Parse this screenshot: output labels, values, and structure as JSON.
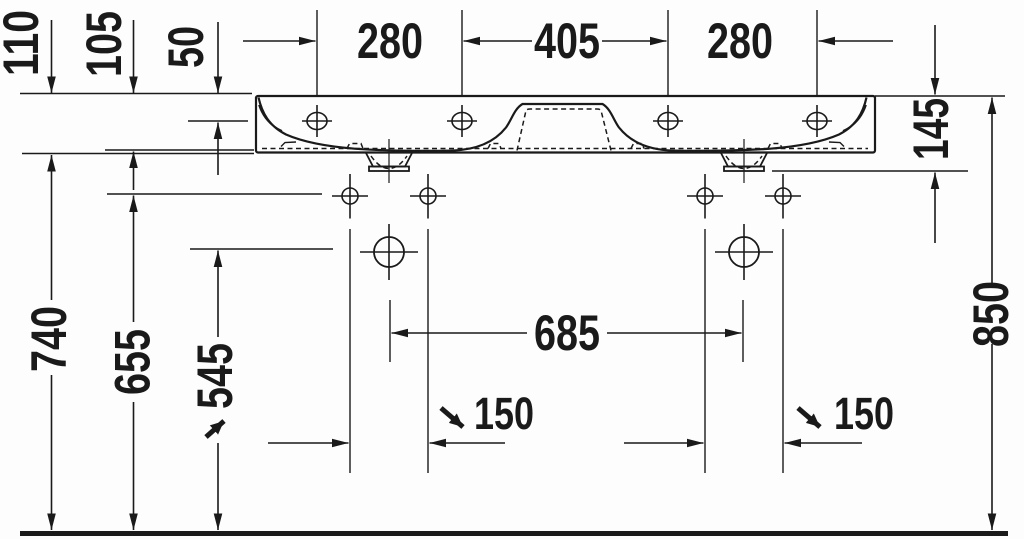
{
  "drawing": {
    "subject": "Double washbasin — front elevation dimension drawing",
    "colors": {
      "line": "#1a1a1a",
      "background": "#ffffff"
    },
    "dimensions": {
      "top_heights": {
        "h110": "110",
        "h105": "105",
        "h50": "50"
      },
      "top_widths": {
        "left": "280",
        "center": "405",
        "right": "280"
      },
      "left_heights": {
        "h740": "740",
        "h655": "655",
        "h545": "545"
      },
      "right_heights": {
        "h145": "145",
        "h850": "850"
      },
      "center_span": "685",
      "hole_spacing": {
        "left": "150",
        "right": "150"
      }
    }
  }
}
